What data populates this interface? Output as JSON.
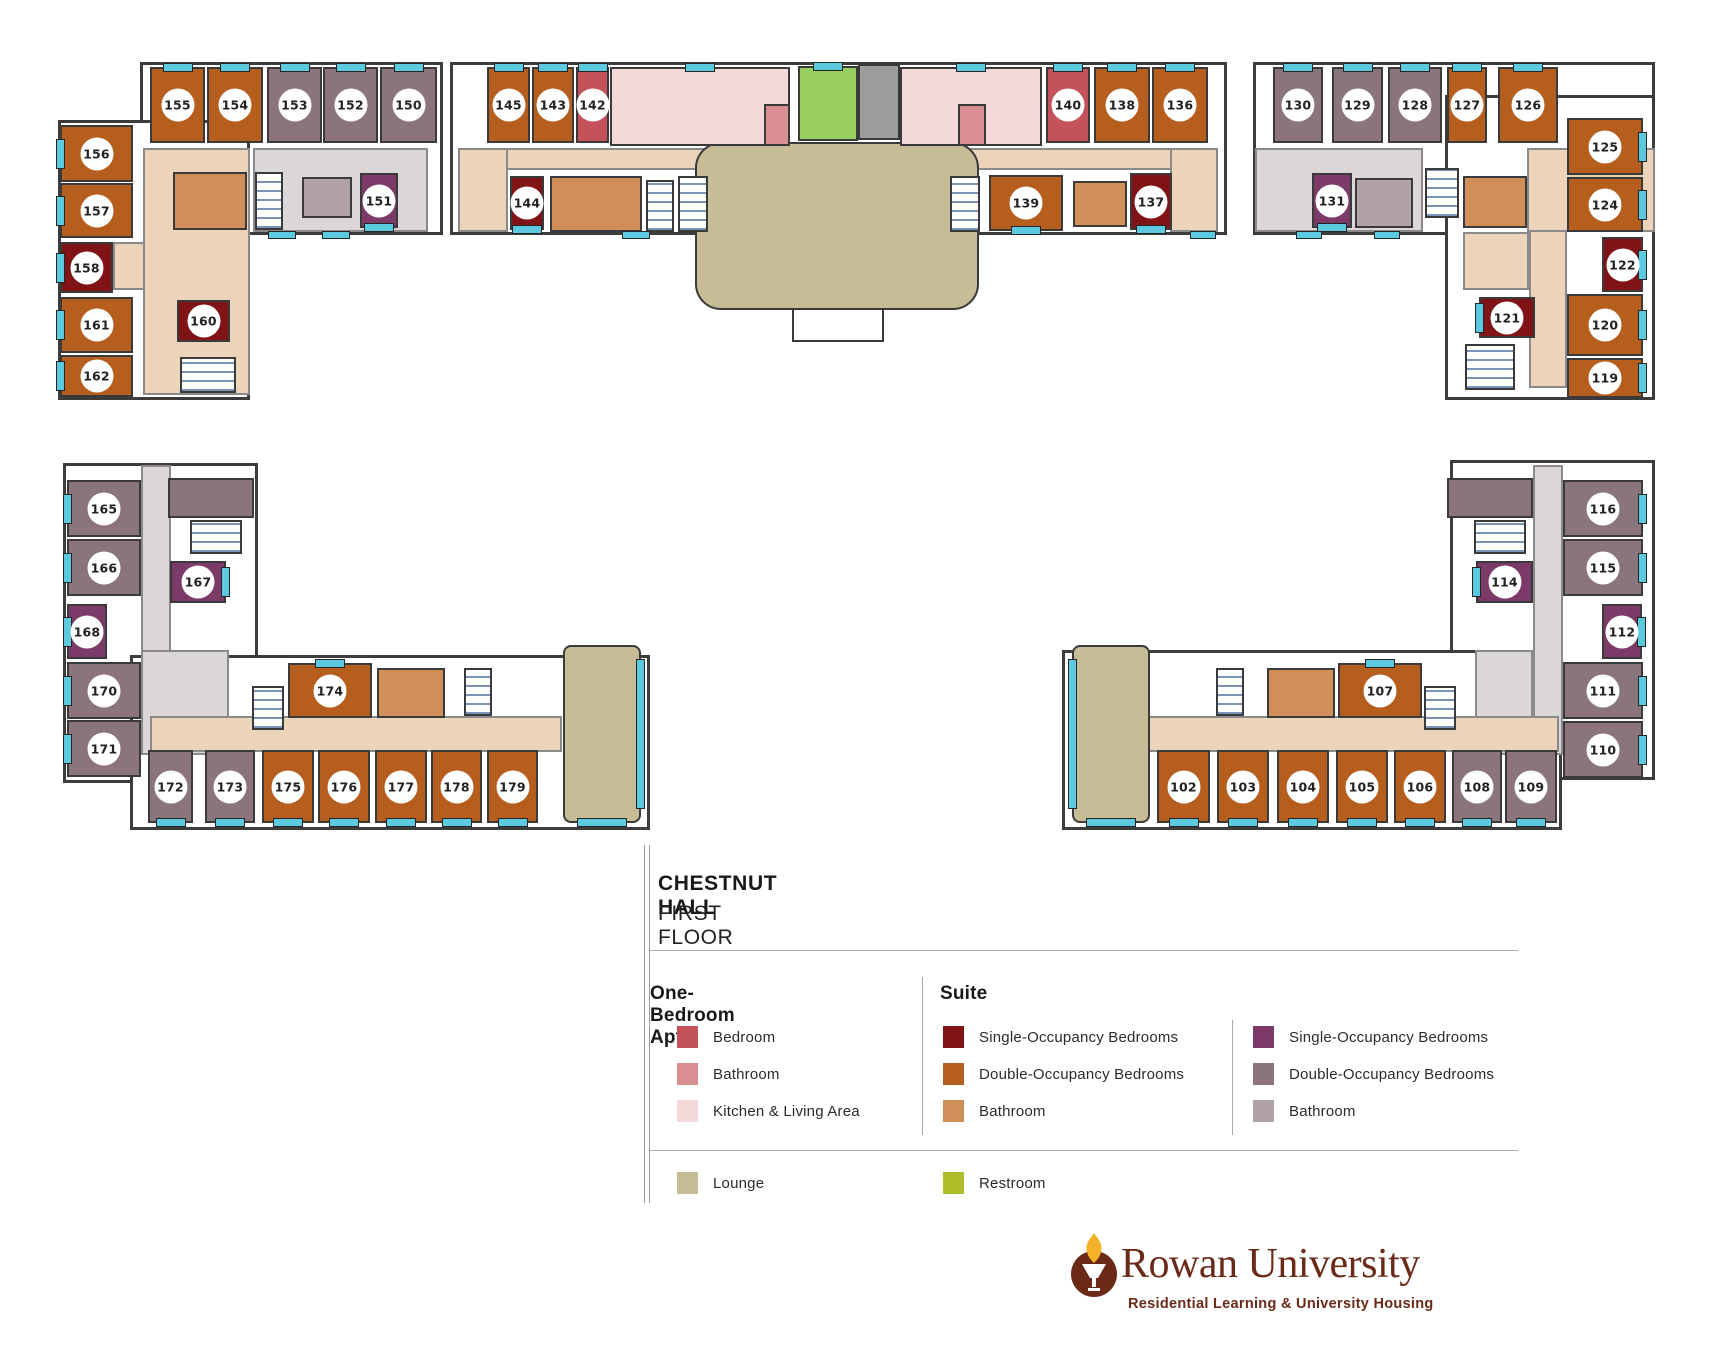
{
  "title": {
    "building": "CHESTNUT HALL",
    "floor": "FIRST FLOOR"
  },
  "legend": {
    "sections": [
      {
        "heading": "One-Bedroom Apt.",
        "items": [
          {
            "label": "Bedroom",
            "color": "#C4525B"
          },
          {
            "label": "Bathroom",
            "color": "#D98F92"
          },
          {
            "label": "Kitchen & Living Area",
            "color": "#F4D9DB"
          }
        ]
      },
      {
        "heading": "Suite",
        "items": [
          {
            "label": "Single-Occupancy Bedrooms",
            "color": "#801315"
          },
          {
            "label": "Double-Occupancy Bedrooms",
            "color": "#B55E1D"
          },
          {
            "label": "Bathroom",
            "color": "#D08F58"
          }
        ]
      },
      {
        "heading": "",
        "items": [
          {
            "label": "Single-Occupancy Bedrooms",
            "color": "#7B3A68"
          },
          {
            "label": "Double-Occupancy Bedrooms",
            "color": "#8B757D"
          },
          {
            "label": "Bathroom",
            "color": "#B1A2A8"
          }
        ]
      }
    ],
    "extra": [
      {
        "label": "Lounge",
        "color": "#C6BC95"
      },
      {
        "label": "Restroom",
        "color": "#AEBE29"
      }
    ]
  },
  "logo": {
    "name": "Rowan University",
    "tagline": "Residential Learning & University Housing",
    "color": "#6B2A18"
  },
  "palette": {
    "od": "#B55E1D",
    "ob": "#D08F58",
    "os": "#801315",
    "pd": "#8B757D",
    "pb": "#B1A2A8",
    "ps": "#7B3A68",
    "bed": "#C4525B",
    "bath": "#D98F92",
    "kit": "#F4D9DB",
    "lounge": "#C6BC95",
    "wc": "#98CF5E",
    "ct": "#ECD4BB",
    "cg": "#DBD6D8",
    "elev": "#9C9C9C",
    "winh": "#5DC9DE"
  },
  "floorplan": {
    "names": {
      "od": "double-occupancy-bedroom",
      "os": "single-occupancy-bedroom",
      "pd": "double-occupancy-bedroom",
      "ps": "single-occupancy-bedroom",
      "ob": "suite-bathroom",
      "pb": "suite-bathroom",
      "bed": "apartment-bedroom",
      "bath": "apartment-bathroom",
      "kit": "kitchen-living-area",
      "wc": "restroom-area",
      "lounge": "lounge-area",
      "ct": "corridor",
      "cg": "corridor",
      "elev": "elevator",
      "stair": "stairwell",
      "portico": "entrance-portico",
      "winh": "window"
    },
    "wings": [
      {
        "x": 140,
        "y": 62,
        "w": 303,
        "h": 173
      },
      {
        "x": 58,
        "y": 120,
        "w": 192,
        "h": 280
      },
      {
        "x": 450,
        "y": 62,
        "w": 777,
        "h": 173
      },
      {
        "x": 1253,
        "y": 62,
        "w": 402,
        "h": 173
      },
      {
        "x": 1445,
        "y": 95,
        "w": 210,
        "h": 305
      },
      {
        "x": 63,
        "y": 463,
        "w": 195,
        "h": 320
      },
      {
        "x": 130,
        "y": 655,
        "w": 520,
        "h": 175
      },
      {
        "x": 1450,
        "y": 460,
        "w": 205,
        "h": 320
      },
      {
        "x": 1062,
        "y": 650,
        "w": 500,
        "h": 180
      }
    ],
    "cells": [
      {
        "t": "ct",
        "x": 143,
        "y": 148,
        "w": 107,
        "h": 247
      },
      {
        "t": "cg",
        "x": 253,
        "y": 148,
        "w": 175,
        "h": 84
      },
      {
        "t": "ct",
        "x": 113,
        "y": 242,
        "w": 32,
        "h": 48
      },
      {
        "t": "ob",
        "x": 173,
        "y": 172,
        "w": 74,
        "h": 58
      },
      {
        "t": "pb",
        "x": 302,
        "y": 177,
        "w": 50,
        "h": 41
      },
      {
        "t": "stair",
        "x": 255,
        "y": 172,
        "w": 28,
        "h": 58
      },
      {
        "t": "stair",
        "x": 180,
        "y": 357,
        "w": 56,
        "h": 36
      },
      {
        "n": "155",
        "t": "od",
        "x": 150,
        "y": 67,
        "w": 55,
        "h": 76,
        "win": "t"
      },
      {
        "n": "154",
        "t": "od",
        "x": 207,
        "y": 67,
        "w": 56,
        "h": 76,
        "win": "t"
      },
      {
        "n": "153",
        "t": "pd",
        "x": 267,
        "y": 67,
        "w": 55,
        "h": 76,
        "win": "t"
      },
      {
        "n": "152",
        "t": "pd",
        "x": 323,
        "y": 67,
        "w": 55,
        "h": 76,
        "win": "t"
      },
      {
        "n": "150",
        "t": "pd",
        "x": 380,
        "y": 67,
        "w": 57,
        "h": 76,
        "win": "t"
      },
      {
        "n": "156",
        "t": "od",
        "x": 60,
        "y": 125,
        "w": 73,
        "h": 57,
        "win": "l"
      },
      {
        "n": "157",
        "t": "od",
        "x": 60,
        "y": 183,
        "w": 73,
        "h": 55,
        "win": "l"
      },
      {
        "n": "158",
        "t": "os",
        "x": 60,
        "y": 242,
        "w": 53,
        "h": 51,
        "win": "l"
      },
      {
        "n": "161",
        "t": "od",
        "x": 60,
        "y": 297,
        "w": 73,
        "h": 56,
        "win": "l"
      },
      {
        "n": "162",
        "t": "od",
        "x": 60,
        "y": 355,
        "w": 73,
        "h": 42,
        "win": "l"
      },
      {
        "n": "160",
        "t": "os",
        "x": 177,
        "y": 300,
        "w": 53,
        "h": 42
      },
      {
        "n": "151",
        "t": "ps",
        "x": 360,
        "y": 173,
        "w": 38,
        "h": 55,
        "win": "b"
      },
      {
        "t": "winh",
        "x": 268,
        "y": 231,
        "w": 28,
        "h": 8
      },
      {
        "t": "winh",
        "x": 322,
        "y": 231,
        "w": 28,
        "h": 8
      },
      {
        "t": "ct",
        "x": 458,
        "y": 148,
        "w": 760,
        "h": 22
      },
      {
        "t": "ct",
        "x": 458,
        "y": 148,
        "w": 50,
        "h": 84
      },
      {
        "t": "ct",
        "x": 1170,
        "y": 148,
        "w": 48,
        "h": 84
      },
      {
        "t": "lounge",
        "x": 695,
        "y": 142,
        "w": 284,
        "h": 168,
        "r": 26
      },
      {
        "t": "kit",
        "x": 610,
        "y": 67,
        "w": 180,
        "h": 79,
        "win": "t"
      },
      {
        "t": "bath",
        "x": 764,
        "y": 104,
        "w": 26,
        "h": 42
      },
      {
        "t": "wc",
        "x": 798,
        "y": 66,
        "w": 60,
        "h": 75,
        "win": "t"
      },
      {
        "t": "elev",
        "x": 858,
        "y": 64,
        "w": 42,
        "h": 76
      },
      {
        "t": "kit",
        "x": 900,
        "y": 67,
        "w": 142,
        "h": 79,
        "win": "t"
      },
      {
        "t": "bath",
        "x": 958,
        "y": 104,
        "w": 28,
        "h": 42
      },
      {
        "t": "ob",
        "x": 550,
        "y": 176,
        "w": 92,
        "h": 56
      },
      {
        "t": "stair",
        "x": 646,
        "y": 180,
        "w": 28,
        "h": 52
      },
      {
        "t": "stair",
        "x": 678,
        "y": 176,
        "w": 30,
        "h": 56
      },
      {
        "t": "stair",
        "x": 950,
        "y": 176,
        "w": 30,
        "h": 56
      },
      {
        "t": "ob",
        "x": 1073,
        "y": 181,
        "w": 54,
        "h": 46
      },
      {
        "t": "portico",
        "x": 792,
        "y": 308,
        "w": 92,
        "h": 34
      },
      {
        "n": "145",
        "t": "od",
        "x": 487,
        "y": 67,
        "w": 43,
        "h": 76,
        "win": "t"
      },
      {
        "n": "143",
        "t": "od",
        "x": 532,
        "y": 67,
        "w": 42,
        "h": 76,
        "win": "t"
      },
      {
        "n": "142",
        "t": "bed",
        "x": 576,
        "y": 67,
        "w": 33,
        "h": 76,
        "win": "t"
      },
      {
        "n": "140",
        "t": "bed",
        "x": 1046,
        "y": 67,
        "w": 44,
        "h": 76,
        "win": "t"
      },
      {
        "n": "138",
        "t": "od",
        "x": 1094,
        "y": 67,
        "w": 56,
        "h": 76,
        "win": "t"
      },
      {
        "n": "136",
        "t": "od",
        "x": 1152,
        "y": 67,
        "w": 56,
        "h": 76,
        "win": "t"
      },
      {
        "n": "144",
        "t": "os",
        "x": 510,
        "y": 176,
        "w": 34,
        "h": 54,
        "win": "b"
      },
      {
        "n": "139",
        "t": "od",
        "x": 989,
        "y": 175,
        "w": 74,
        "h": 56,
        "win": "b"
      },
      {
        "n": "137",
        "t": "os",
        "x": 1130,
        "y": 173,
        "w": 42,
        "h": 57,
        "win": "b"
      },
      {
        "t": "winh",
        "x": 622,
        "y": 231,
        "w": 28,
        "h": 8
      },
      {
        "t": "winh",
        "x": 1190,
        "y": 231,
        "w": 26,
        "h": 8
      },
      {
        "t": "cg",
        "x": 1255,
        "y": 148,
        "w": 168,
        "h": 84
      },
      {
        "t": "ct",
        "x": 1527,
        "y": 148,
        "w": 128,
        "h": 84
      },
      {
        "t": "ct",
        "x": 1529,
        "y": 230,
        "w": 38,
        "h": 158
      },
      {
        "t": "ct",
        "x": 1463,
        "y": 232,
        "w": 66,
        "h": 58
      },
      {
        "t": "pb",
        "x": 1355,
        "y": 178,
        "w": 58,
        "h": 50
      },
      {
        "t": "ob",
        "x": 1463,
        "y": 176,
        "w": 64,
        "h": 52
      },
      {
        "t": "stair",
        "x": 1425,
        "y": 168,
        "w": 34,
        "h": 50
      },
      {
        "t": "stair",
        "x": 1465,
        "y": 344,
        "w": 50,
        "h": 46
      },
      {
        "n": "130",
        "t": "pd",
        "x": 1273,
        "y": 67,
        "w": 50,
        "h": 76,
        "win": "t"
      },
      {
        "n": "129",
        "t": "pd",
        "x": 1332,
        "y": 67,
        "w": 51,
        "h": 76,
        "win": "t"
      },
      {
        "n": "128",
        "t": "pd",
        "x": 1388,
        "y": 67,
        "w": 54,
        "h": 76,
        "win": "t"
      },
      {
        "n": "127",
        "t": "od",
        "x": 1447,
        "y": 67,
        "w": 40,
        "h": 76,
        "win": "t"
      },
      {
        "n": "126",
        "t": "od",
        "x": 1498,
        "y": 67,
        "w": 60,
        "h": 76,
        "win": "t"
      },
      {
        "n": "131",
        "t": "ps",
        "x": 1312,
        "y": 173,
        "w": 40,
        "h": 55,
        "win": "b"
      },
      {
        "n": "125",
        "t": "od",
        "x": 1567,
        "y": 118,
        "w": 76,
        "h": 57,
        "win": "r"
      },
      {
        "n": "124",
        "t": "od",
        "x": 1567,
        "y": 177,
        "w": 76,
        "h": 55,
        "win": "r"
      },
      {
        "n": "122",
        "t": "os",
        "x": 1602,
        "y": 237,
        "w": 41,
        "h": 55,
        "win": "r"
      },
      {
        "n": "121",
        "t": "os",
        "x": 1479,
        "y": 297,
        "w": 56,
        "h": 41,
        "win": "l"
      },
      {
        "n": "120",
        "t": "od",
        "x": 1567,
        "y": 294,
        "w": 76,
        "h": 62,
        "win": "r"
      },
      {
        "n": "119",
        "t": "od",
        "x": 1567,
        "y": 358,
        "w": 76,
        "h": 40,
        "win": "r"
      },
      {
        "t": "winh",
        "x": 1296,
        "y": 231,
        "w": 26,
        "h": 8
      },
      {
        "t": "winh",
        "x": 1374,
        "y": 231,
        "w": 26,
        "h": 8
      },
      {
        "t": "cg",
        "x": 141,
        "y": 465,
        "w": 30,
        "h": 290
      },
      {
        "t": "cg",
        "x": 141,
        "y": 650,
        "w": 88,
        "h": 105
      },
      {
        "t": "ct",
        "x": 150,
        "y": 716,
        "w": 412,
        "h": 36
      },
      {
        "t": "pd",
        "x": 168,
        "y": 478,
        "w": 86,
        "h": 40
      },
      {
        "t": "stair",
        "x": 190,
        "y": 520,
        "w": 52,
        "h": 34
      },
      {
        "t": "ob",
        "x": 377,
        "y": 668,
        "w": 68,
        "h": 50
      },
      {
        "t": "stair",
        "x": 464,
        "y": 668,
        "w": 28,
        "h": 48
      },
      {
        "t": "stair",
        "x": 252,
        "y": 686,
        "w": 32,
        "h": 44
      },
      {
        "t": "lounge",
        "x": 563,
        "y": 645,
        "w": 78,
        "h": 178,
        "r": 8,
        "win": "RB"
      },
      {
        "n": "165",
        "t": "pd",
        "x": 67,
        "y": 480,
        "w": 74,
        "h": 57,
        "win": "l"
      },
      {
        "n": "166",
        "t": "pd",
        "x": 67,
        "y": 539,
        "w": 74,
        "h": 57,
        "win": "l"
      },
      {
        "n": "167",
        "t": "ps",
        "x": 170,
        "y": 561,
        "w": 56,
        "h": 42,
        "win": "r"
      },
      {
        "n": "168",
        "t": "ps",
        "x": 67,
        "y": 604,
        "w": 40,
        "h": 55,
        "win": "l"
      },
      {
        "n": "170",
        "t": "pd",
        "x": 67,
        "y": 662,
        "w": 74,
        "h": 57,
        "win": "l"
      },
      {
        "n": "171",
        "t": "pd",
        "x": 67,
        "y": 720,
        "w": 74,
        "h": 57,
        "win": "l"
      },
      {
        "n": "174",
        "t": "od",
        "x": 288,
        "y": 663,
        "w": 84,
        "h": 55,
        "win": "t"
      },
      {
        "n": "172",
        "t": "pd",
        "x": 148,
        "y": 750,
        "w": 45,
        "h": 73,
        "win": "b"
      },
      {
        "n": "173",
        "t": "pd",
        "x": 205,
        "y": 750,
        "w": 50,
        "h": 73,
        "win": "b"
      },
      {
        "n": "175",
        "t": "od",
        "x": 262,
        "y": 750,
        "w": 52,
        "h": 73,
        "win": "b"
      },
      {
        "n": "176",
        "t": "od",
        "x": 318,
        "y": 750,
        "w": 52,
        "h": 73,
        "win": "b"
      },
      {
        "n": "177",
        "t": "od",
        "x": 375,
        "y": 750,
        "w": 52,
        "h": 73,
        "win": "b"
      },
      {
        "n": "178",
        "t": "od",
        "x": 431,
        "y": 750,
        "w": 51,
        "h": 73,
        "win": "b"
      },
      {
        "n": "179",
        "t": "od",
        "x": 487,
        "y": 750,
        "w": 51,
        "h": 73,
        "win": "b"
      },
      {
        "t": "cg",
        "x": 1533,
        "y": 465,
        "w": 30,
        "h": 290
      },
      {
        "t": "cg",
        "x": 1475,
        "y": 650,
        "w": 58,
        "h": 105
      },
      {
        "t": "ct",
        "x": 1147,
        "y": 716,
        "w": 412,
        "h": 36
      },
      {
        "t": "pd",
        "x": 1447,
        "y": 478,
        "w": 86,
        "h": 40
      },
      {
        "t": "stair",
        "x": 1474,
        "y": 520,
        "w": 52,
        "h": 34
      },
      {
        "t": "ob",
        "x": 1267,
        "y": 668,
        "w": 68,
        "h": 50
      },
      {
        "t": "stair",
        "x": 1216,
        "y": 668,
        "w": 28,
        "h": 48
      },
      {
        "t": "stair",
        "x": 1424,
        "y": 686,
        "w": 32,
        "h": 44
      },
      {
        "t": "lounge",
        "x": 1072,
        "y": 645,
        "w": 78,
        "h": 178,
        "r": 8,
        "win": "LB"
      },
      {
        "n": "116",
        "t": "pd",
        "x": 1563,
        "y": 480,
        "w": 80,
        "h": 57,
        "win": "r"
      },
      {
        "n": "115",
        "t": "pd",
        "x": 1563,
        "y": 539,
        "w": 80,
        "h": 57,
        "win": "r"
      },
      {
        "n": "114",
        "t": "ps",
        "x": 1476,
        "y": 561,
        "w": 57,
        "h": 42,
        "win": "l"
      },
      {
        "n": "112",
        "t": "ps",
        "x": 1602,
        "y": 604,
        "w": 40,
        "h": 55,
        "win": "r"
      },
      {
        "n": "111",
        "t": "pd",
        "x": 1563,
        "y": 662,
        "w": 80,
        "h": 57,
        "win": "r"
      },
      {
        "n": "110",
        "t": "pd",
        "x": 1563,
        "y": 721,
        "w": 80,
        "h": 57,
        "win": "r"
      },
      {
        "n": "107",
        "t": "od",
        "x": 1338,
        "y": 663,
        "w": 84,
        "h": 55,
        "win": "t"
      },
      {
        "n": "102",
        "t": "od",
        "x": 1157,
        "y": 750,
        "w": 53,
        "h": 73,
        "win": "b"
      },
      {
        "n": "103",
        "t": "od",
        "x": 1217,
        "y": 750,
        "w": 52,
        "h": 73,
        "win": "b"
      },
      {
        "n": "104",
        "t": "od",
        "x": 1277,
        "y": 750,
        "w": 52,
        "h": 73,
        "win": "b"
      },
      {
        "n": "105",
        "t": "od",
        "x": 1336,
        "y": 750,
        "w": 52,
        "h": 73,
        "win": "b"
      },
      {
        "n": "106",
        "t": "od",
        "x": 1394,
        "y": 750,
        "w": 52,
        "h": 73,
        "win": "b"
      },
      {
        "n": "108",
        "t": "pd",
        "x": 1452,
        "y": 750,
        "w": 50,
        "h": 73,
        "win": "b"
      },
      {
        "n": "109",
        "t": "pd",
        "x": 1505,
        "y": 750,
        "w": 52,
        "h": 73,
        "win": "b"
      }
    ]
  }
}
